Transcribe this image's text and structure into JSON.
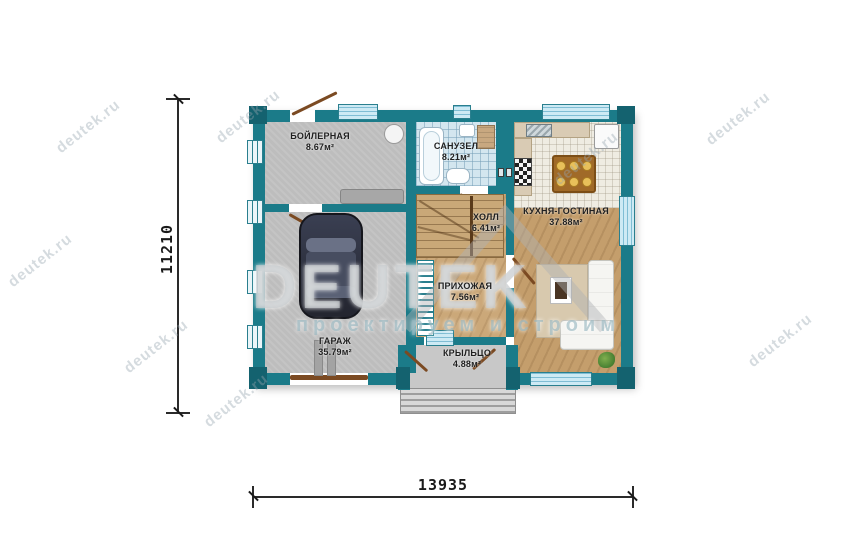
{
  "watermark": {
    "brand": "DEUTEK",
    "tagline": "проектируем и строим",
    "site": "deutek.ru"
  },
  "dimensions": {
    "height_mm": "11210",
    "width_mm": "13935"
  },
  "rooms": {
    "boiler": {
      "name": "БОЙЛЕРНАЯ",
      "area": "8.67м²"
    },
    "bathroom": {
      "name": "САНУЗЕЛ",
      "area": "8.21м²"
    },
    "hall": {
      "name": "ХОЛЛ",
      "area": "6.41м²"
    },
    "kitchen_living": {
      "name": "КУХНЯ-ГОСТИНАЯ",
      "area": "37.88м²"
    },
    "garage": {
      "name": "ГАРАЖ",
      "area": "35.79м²"
    },
    "entry": {
      "name": "ПРИХОЖАЯ",
      "area": "7.56м²"
    },
    "porch": {
      "name": "КРЫЛЬЦО",
      "area": "4.88м²"
    }
  },
  "colors": {
    "wall": "#1b7b89",
    "glass": "#cdeaf4",
    "wood": "#c49e6c",
    "bath_tile": "#d3e6ef",
    "concrete": "#bdbdbd",
    "door": "#7b4a22"
  }
}
